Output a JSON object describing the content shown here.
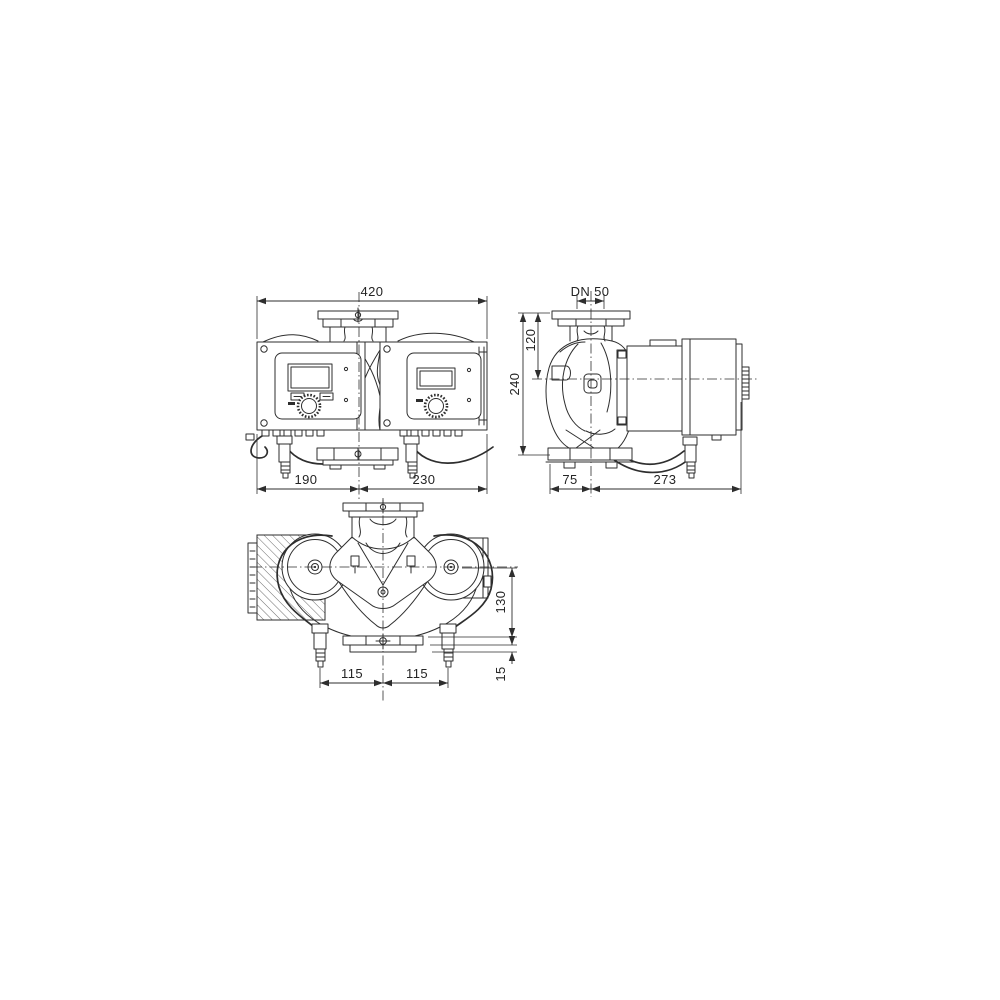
{
  "page": {
    "background_color": "#ffffff"
  },
  "drawing": {
    "line_color": "#2e2e2e",
    "views": {
      "front": {
        "dims": {
          "total_width": "420",
          "axis_to_left": "190",
          "axis_to_right": "230"
        }
      },
      "side": {
        "dims": {
          "nominal_diameter": "DN 50",
          "flange_to_axis": "120",
          "overall_height": "240",
          "axis_to_flange_edge": "75",
          "axis_to_motor_end": "273"
        }
      },
      "top": {
        "dims": {
          "axis_to_base": "130",
          "base_offset": "15",
          "axis_to_left_plug": "115",
          "axis_to_right_plug": "115"
        }
      }
    }
  }
}
